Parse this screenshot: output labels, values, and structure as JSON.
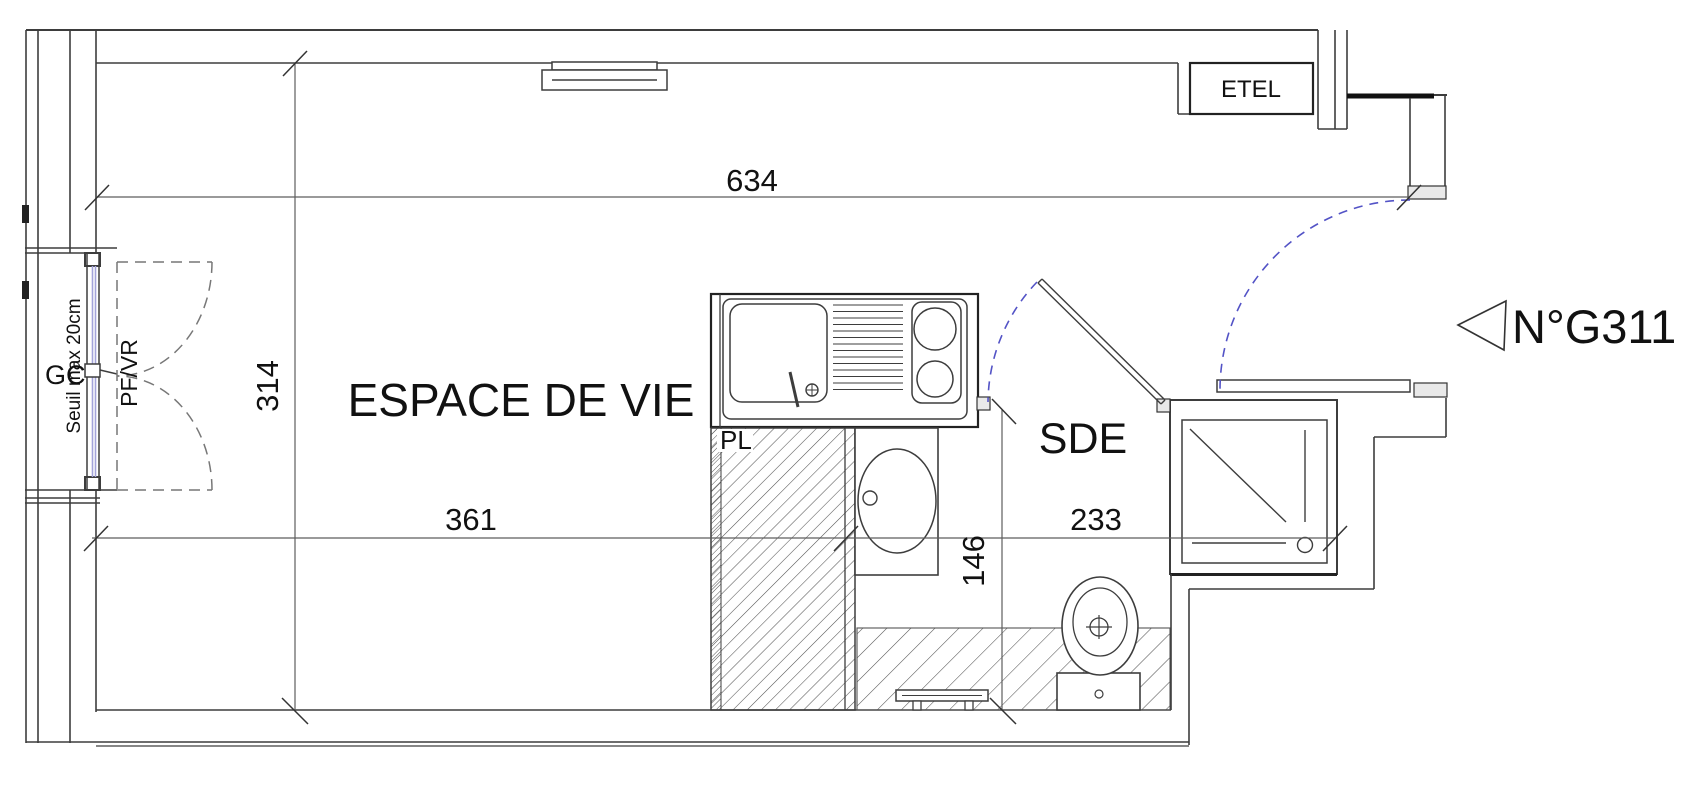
{
  "plan": {
    "rooms": {
      "living": "ESPACE DE VIE",
      "shower_room": "SDE",
      "closet": "PL",
      "electrical_panel": "ETEL"
    },
    "unit": {
      "number": "N°G311"
    },
    "window": {
      "type_label": "PF/VR",
      "threshold_note": "Seuil max 20cm",
      "duct_label": "GC"
    },
    "dimensions": {
      "total_width": "634",
      "total_depth": "314",
      "living_width": "361",
      "shower_room_width": "233",
      "shower_room_depth": "146"
    },
    "colors": {
      "door_swing_blue": "#5353c6",
      "glazing_blue": "#a3a3da",
      "line_dark": "#3d3d3d",
      "jamb_fill": "#e9e9e9"
    }
  }
}
